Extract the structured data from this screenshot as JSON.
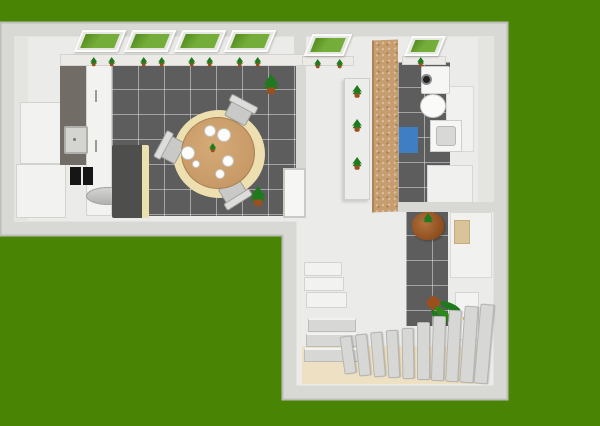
{
  "meta": {
    "scene": "aerial-3d-floor-plan-render",
    "canvas_size": "600x426"
  },
  "colors": {
    "grass": "#4a8404",
    "wall": "#d8d8d4",
    "wall_edge": "#bcbcb8",
    "floor": "#ebebe9",
    "tile": "#5d5d5d",
    "glass": "#74ad3a",
    "frame": "#e6e6e2",
    "wood": "#c79a67",
    "rug": "#eedfb0",
    "chair": "#c9c9c7",
    "sofa": "#4e4e4c",
    "sofa_trim": "#e9e1ae",
    "counter": "#716d66",
    "cork": "#c69d6f",
    "appliance": "#161616",
    "mat_blue": "#3f7ec2",
    "beige_floor": "#eee0c2",
    "stair": "#d7d7d5",
    "plant": "#1f7a1d",
    "pot": "#9a4f1e",
    "handle_yellow": "#d8b82a"
  },
  "inventory": {
    "windows": 6,
    "windowsill_plants": 11,
    "shelf_plants": 3,
    "floor_plants": 2,
    "hall_plants": 2,
    "dining_chairs": 3,
    "plates": 6,
    "stair_steps": 13,
    "storage_boxes": 3
  },
  "objects": {
    "building": "L-shaped apartment floor plan",
    "kitchen_counter": "Kitchen counter",
    "kitchen_cabinets": "Kitchen cabinets",
    "kitchen_sink": "Kitchen sink",
    "cooktop": "Cooktop",
    "cylinder": "Cylinder appliance",
    "sofa": "Bench sofa",
    "dining_table": "Round dining table",
    "dining_chair": "Dining chair",
    "plate": "Plate",
    "rug": "Round rug",
    "window": "Window with grass view",
    "sill_plant": "Small potted plant",
    "plant_shelf": "Plant shelf",
    "cork_partition": "Wood partition wall",
    "washing_machine": "Washing machine",
    "toilet": "Toilet",
    "bathroom_sink": "Bathroom sink",
    "bath_mat": "Blue bath mat",
    "bathroom_cabinet": "Bathroom cabinet",
    "hall_plant": "Large potted plant",
    "fallen_plant": "Tilted potted plant",
    "sideboard": "Sideboard",
    "tray": "Tray",
    "storage_shelves": "Storage shelves",
    "stairs": "Staircase",
    "entry_door": "Interior door",
    "closet_door": "Closet door",
    "door_handle": "Door handle"
  }
}
